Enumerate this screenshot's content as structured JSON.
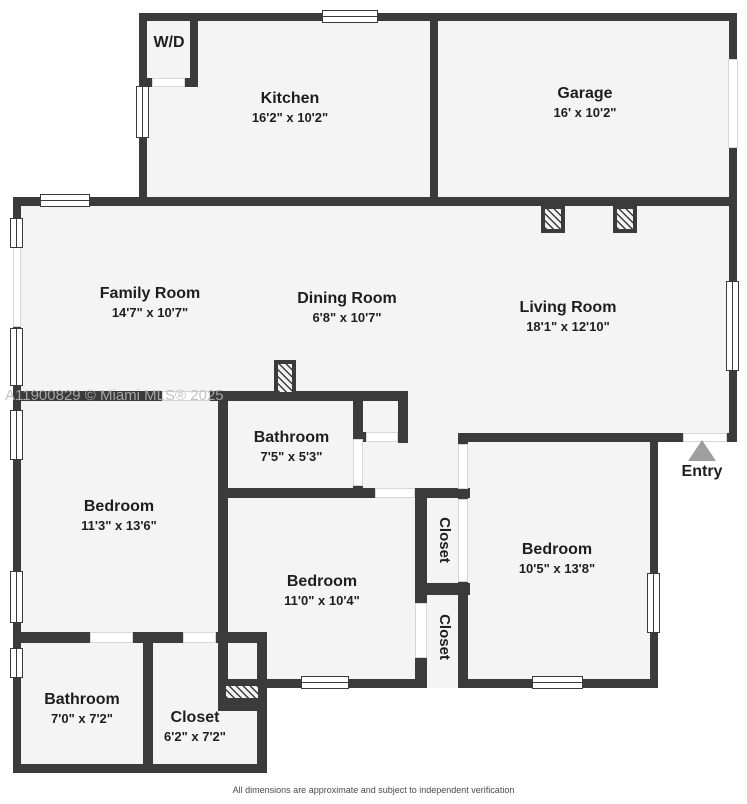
{
  "watermark": "A11900829 © Miami MLS® 2025",
  "disclaimer": "All dimensions are approximate and subject to independent verification",
  "entry": {
    "label": "Entry"
  },
  "rooms": {
    "wd": {
      "name": "W/D",
      "dims": ""
    },
    "kitchen": {
      "name": "Kitchen",
      "dims": "16'2\" x 10'2\""
    },
    "garage": {
      "name": "Garage",
      "dims": "16' x 10'2\""
    },
    "family": {
      "name": "Family Room",
      "dims": "14'7\" x 10'7\""
    },
    "dining": {
      "name": "Dining Room",
      "dims": "6'8\" x 10'7\""
    },
    "living": {
      "name": "Living Room",
      "dims": "18'1\" x 12'10\""
    },
    "bathroom_main": {
      "name": "Bathroom",
      "dims": "7'5\" x 5'3\""
    },
    "bedroom_left": {
      "name": "Bedroom",
      "dims": "11'3\" x 13'6\""
    },
    "bedroom_middle": {
      "name": "Bedroom",
      "dims": "11'0\" x 10'4\""
    },
    "bedroom_right": {
      "name": "Bedroom",
      "dims": "10'5\" x 13'8\""
    },
    "closet_upper": {
      "name": "Closet"
    },
    "closet_lower": {
      "name": "Closet"
    },
    "bathroom_annex": {
      "name": "Bathroom",
      "dims": "7'0\" x 7'2\""
    },
    "closet_annex": {
      "name": "Closet",
      "dims": "6'2\" x 7'2\""
    }
  },
  "colors": {
    "wall": "#3b3b3b",
    "floor": "#f4f4f4",
    "entry_arrow": "#9e9e9e"
  }
}
